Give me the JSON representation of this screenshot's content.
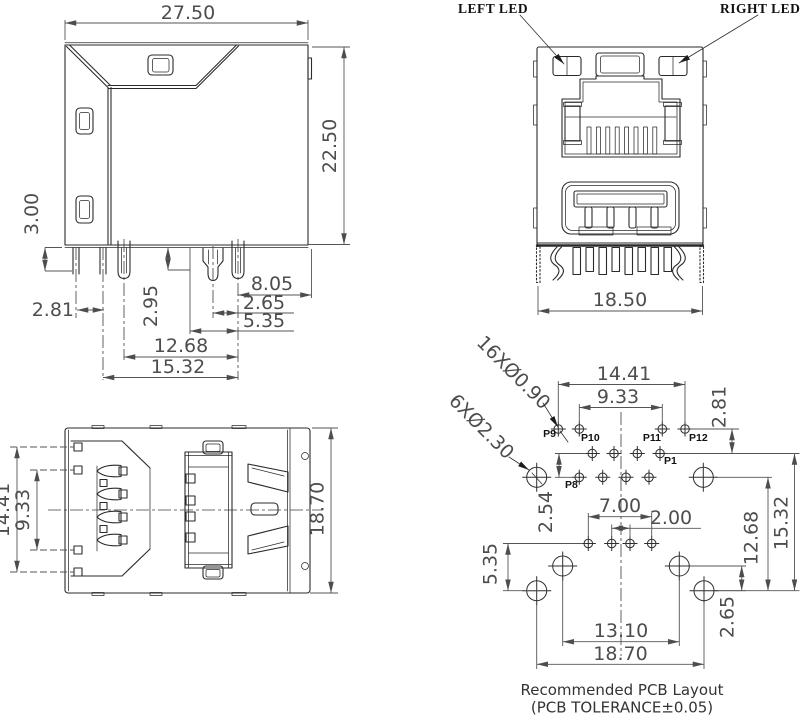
{
  "side": {
    "d2750": "27.50",
    "d2250": "22.50",
    "d300": "3.00",
    "d281": "2.81",
    "d295": "2.95",
    "d805": "8.05",
    "d265": "2.65",
    "d535": "5.35",
    "d1268": "12.68",
    "d1532": "15.32"
  },
  "front": {
    "left_led": "LEFT LED",
    "right_led": "RIGHT LED",
    "d1850": "18.50"
  },
  "bottom": {
    "d1441": "14.41",
    "d933": "9.33",
    "d1870": "18.70"
  },
  "pcb": {
    "callout_small": "16XØ0.90",
    "callout_large": "6XØ2.30",
    "p9": "P9",
    "p10": "P10",
    "p11": "P11",
    "p12": "P12",
    "p1": "P1",
    "p8": "P8",
    "d1441": "14.41",
    "d933": "9.33",
    "d281": "2.81",
    "d254": "2.54",
    "d700": "7.00",
    "d200": "2.00",
    "d535": "5.35",
    "d1310": "13.10",
    "d1870": "18.70",
    "d265": "2.65",
    "d1268": "12.68",
    "d1532": "15.32"
  },
  "footer": {
    "title": "Recommended PCB Layout",
    "tolerance": "(PCB TOLERANCE±0.05)"
  }
}
